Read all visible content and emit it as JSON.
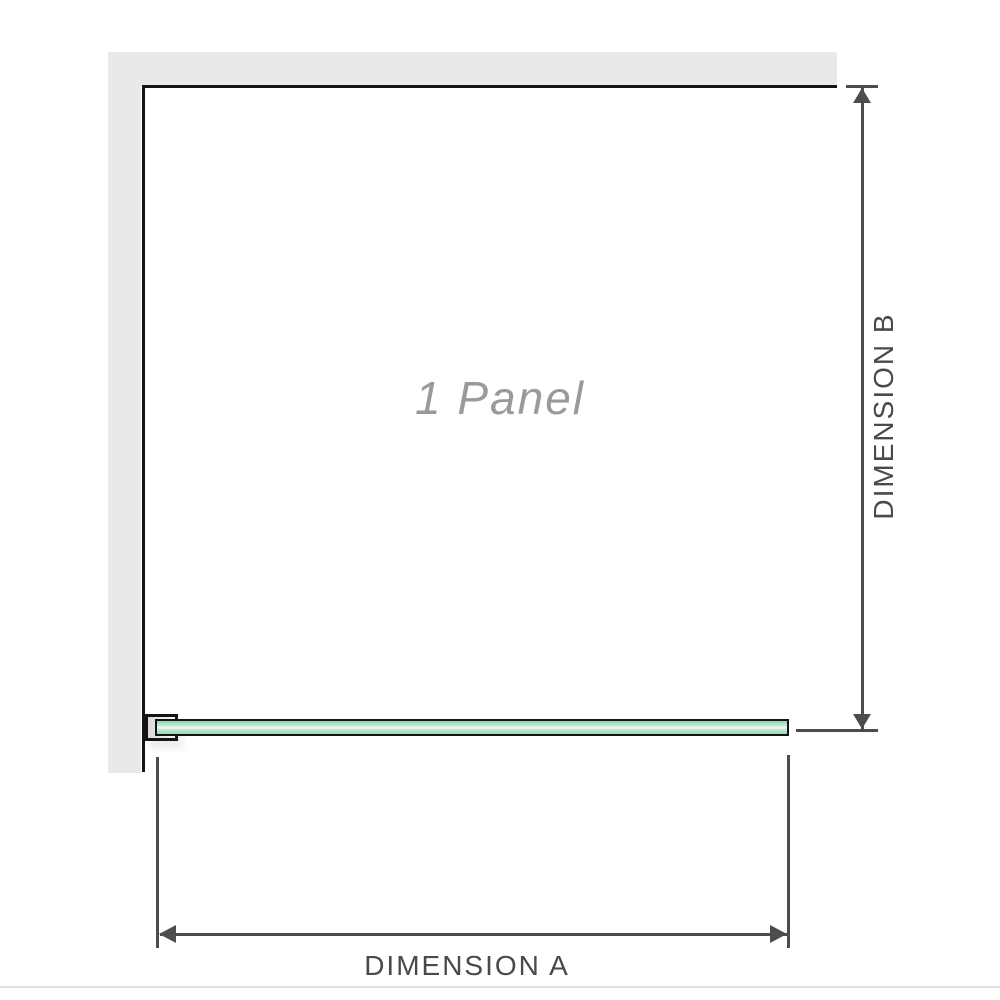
{
  "diagram": {
    "title": "1 Panel shower screen plan diagram",
    "panel_label": "1 Panel",
    "dimensions": {
      "a_label": "DIMENSION A",
      "b_label": "DIMENSION B"
    },
    "colors": {
      "background": "#ffffff",
      "wall_fill": "#e9e9e9",
      "panel_outline": "#141414",
      "glass_green": "#a0d9b8",
      "glass_green_highlight": "#eef9f2",
      "bracket_fill": "#d9d9d9",
      "dimension_line": "#4d4d4d",
      "dimension_text": "#4a4a4a",
      "panel_label_text": "#9a9a9a",
      "separator": "#dce2e6"
    }
  }
}
